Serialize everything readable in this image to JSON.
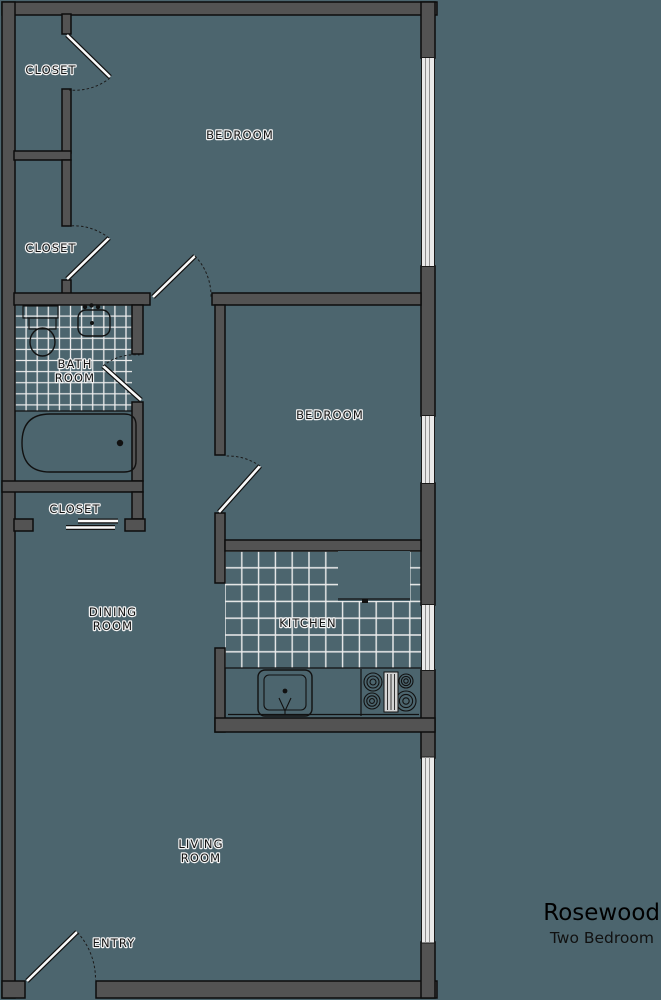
{
  "plan": {
    "title": "Rosewood",
    "subtitle": "Two Bedroom",
    "rooms": {
      "closet_top": "CLOSET",
      "closet_mid": "CLOSET",
      "closet_hall": "CLOSET",
      "bedroom_main": "BEDROOM",
      "bedroom_second": "BEDROOM",
      "bath_line1": "BATH",
      "bath_line2": "ROOM",
      "dining_line1": "DINING",
      "dining_line2": "ROOM",
      "kitchen": "KITCHEN",
      "living_line1": "LIVING",
      "living_line2": "ROOM",
      "entry": "ENTRY"
    }
  },
  "colors": {
    "background": "#4c656e",
    "wall_fill": "#535353",
    "wall_outline": "#0d0d0d",
    "tile_line": "#ededed",
    "window_fill": "#e9e9e9",
    "window_line": "#8f8f8f",
    "label_text": "#141414",
    "label_halo": "#f2f2f2",
    "title_text": "#000000",
    "door_line": "#101010",
    "door_fill": "#fafafa",
    "fixture_line": "#111111"
  }
}
